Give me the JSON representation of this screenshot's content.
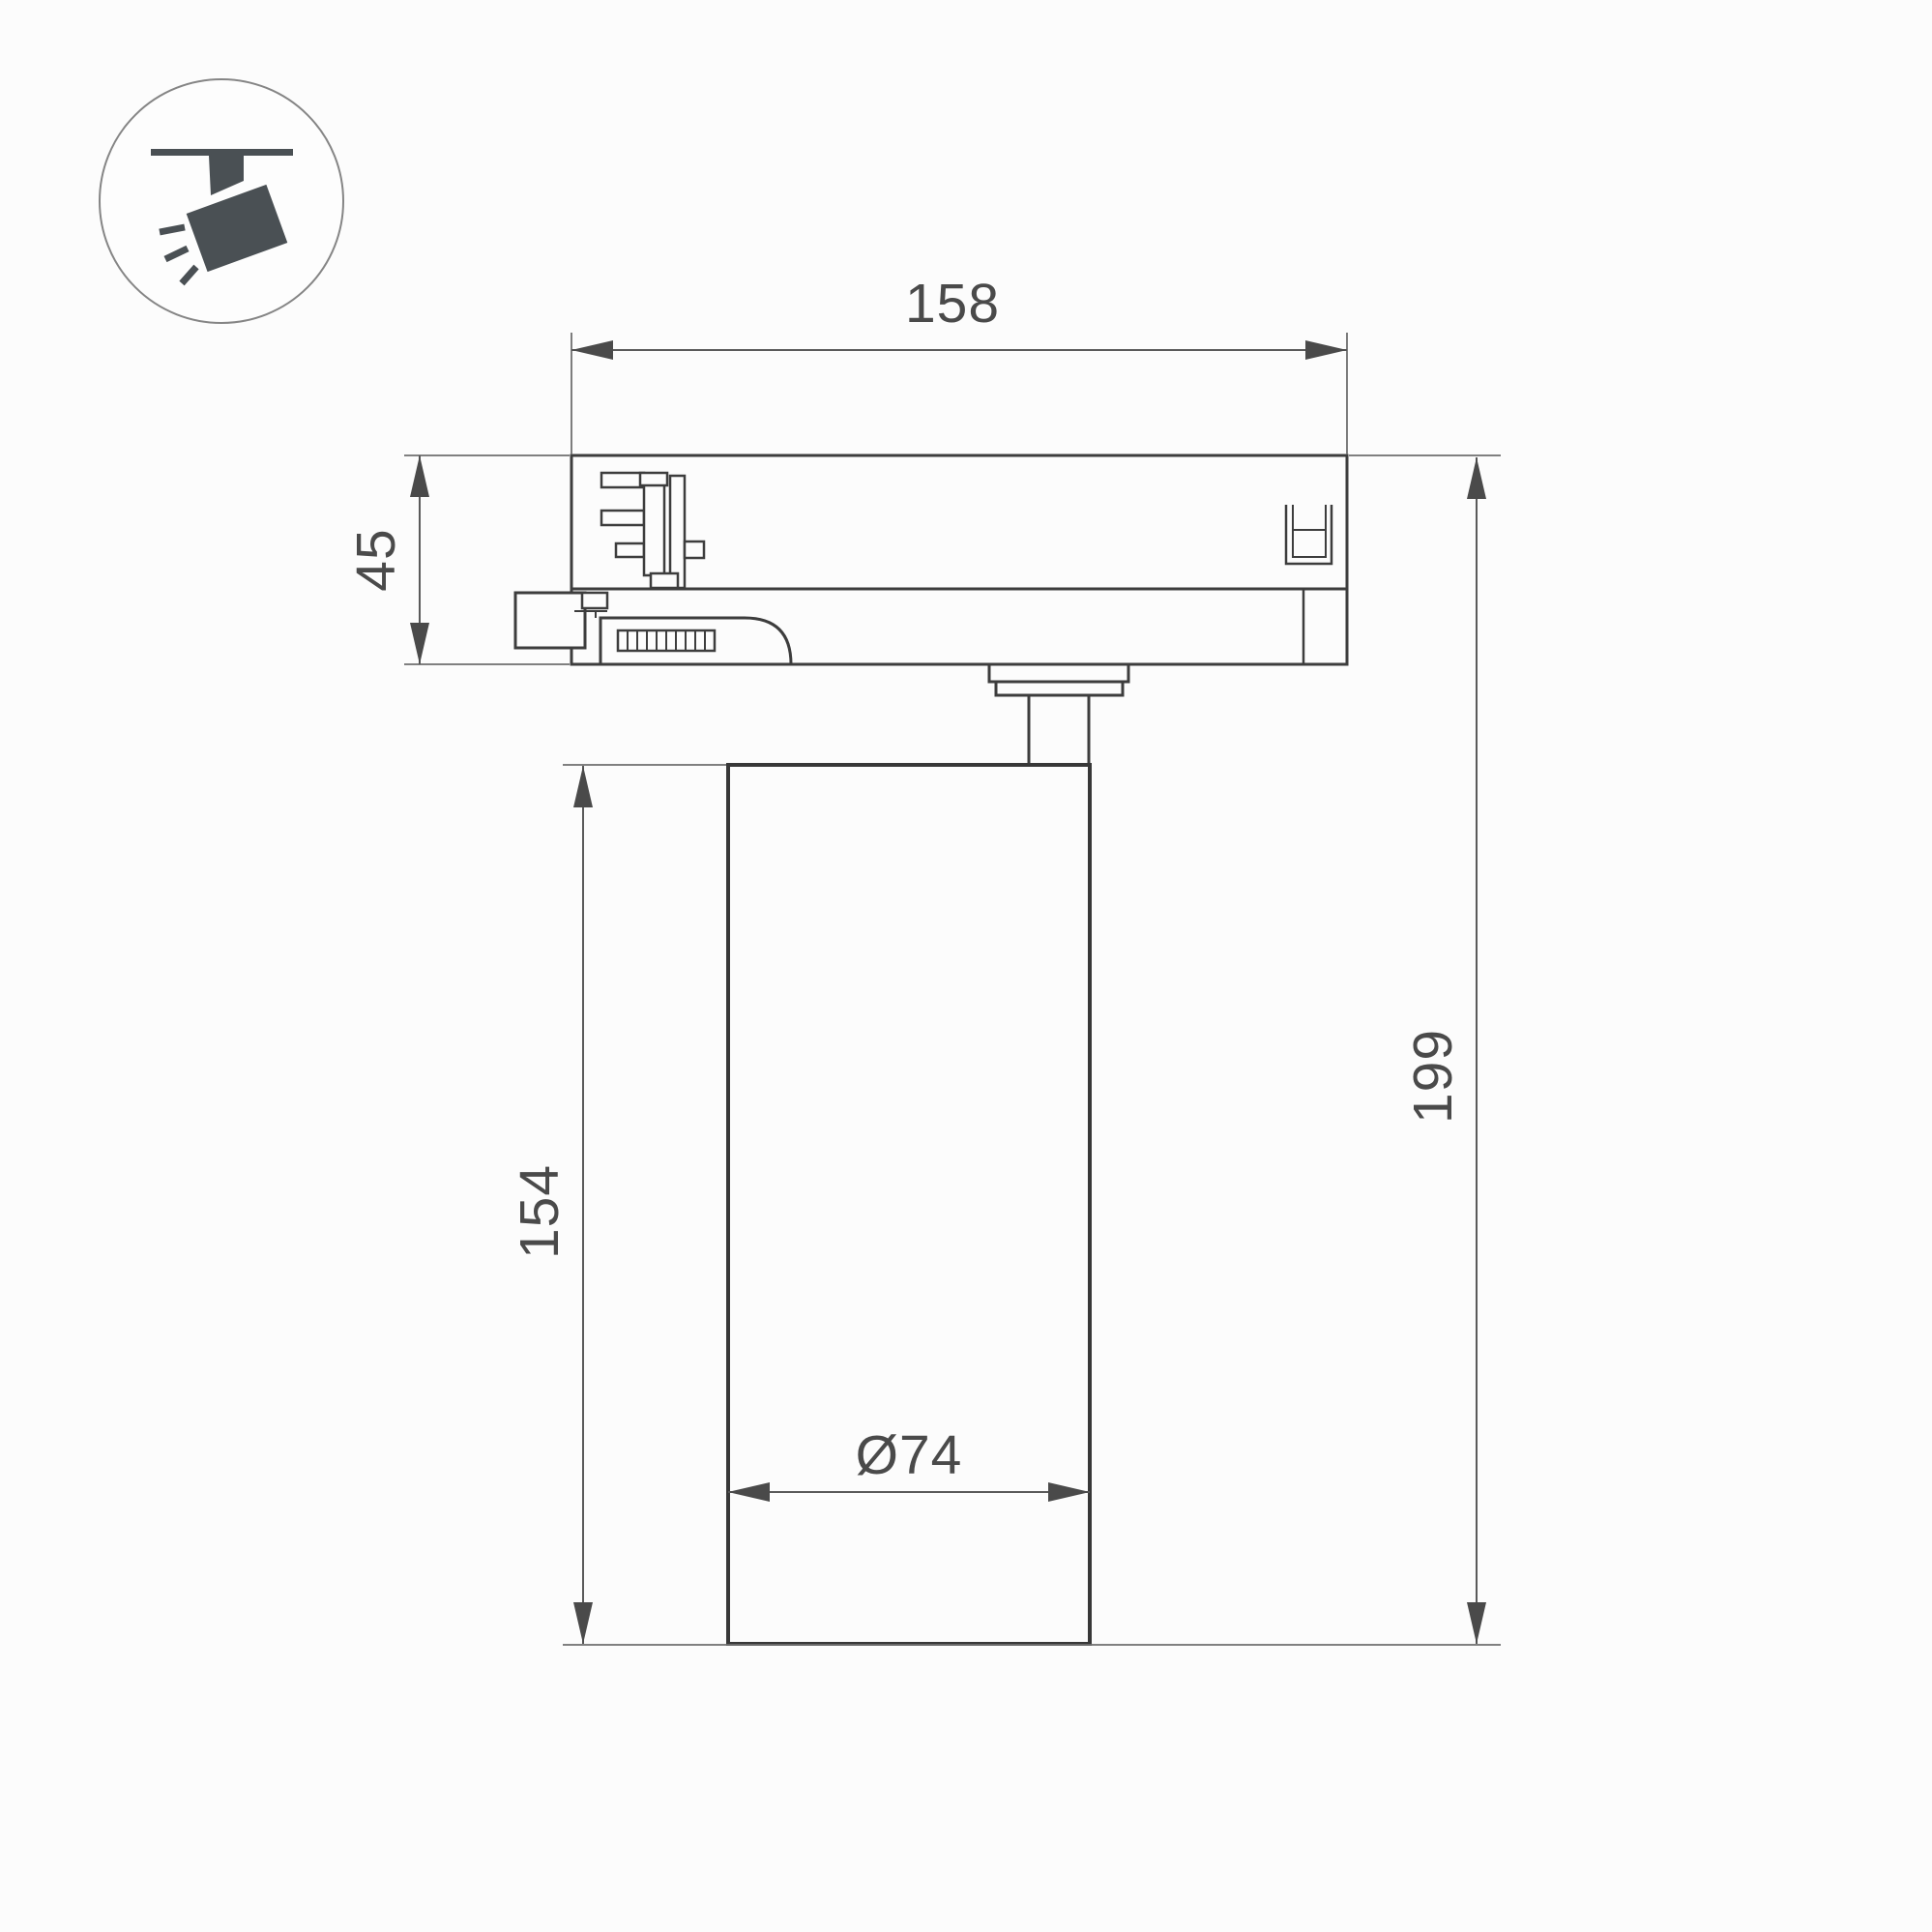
{
  "drawing": {
    "title": "track-spotlight-dimension-drawing",
    "icon": {
      "name": "track-spotlight-pictogram"
    },
    "dimensions": {
      "width": "158",
      "adapter_height": "45",
      "body_height": "154",
      "total_height": "199",
      "diameter": "Ø74"
    },
    "colors": {
      "outline": "#3d3d3d",
      "dimension": "#5a5a5a",
      "text": "#4a4a4a",
      "icon": "#4a5054",
      "background": "#fcfcfc"
    }
  }
}
